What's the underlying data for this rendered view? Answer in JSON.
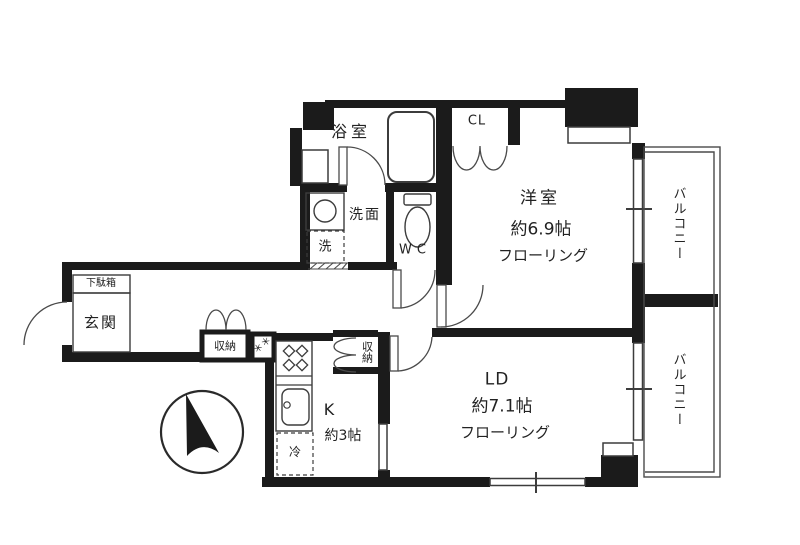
{
  "plan": {
    "type": "apartment-floor-plan",
    "rooms": {
      "bath": {
        "label": "浴室"
      },
      "washroom": {
        "label": "洗面"
      },
      "washer": {
        "label": "洗"
      },
      "toilet": {
        "label": "WC"
      },
      "closet": {
        "label": "CL"
      },
      "western_room": {
        "name": "洋室",
        "size": "約6.9帖",
        "floor": "フローリング"
      },
      "living_dining": {
        "name": "LD",
        "size": "約7.1帖",
        "floor": "フローリング"
      },
      "kitchen": {
        "name": "K",
        "size": "約3帖"
      },
      "fridge": {
        "label": "冷"
      },
      "entrance": {
        "label": "玄関"
      },
      "shoe_box": {
        "label": "下駄箱"
      },
      "storage_hall": {
        "label": "収納"
      },
      "storage_kitchen": {
        "label": "収納"
      },
      "balcony_upper": {
        "label": "バルコニー"
      },
      "balcony_lower": {
        "label": "バルコニー"
      },
      "utility_marks": {
        "label": "＊＊"
      }
    },
    "colors": {
      "wall": "#1b1b1b",
      "line": "#3c3c3c",
      "background": "#ffffff"
    }
  }
}
